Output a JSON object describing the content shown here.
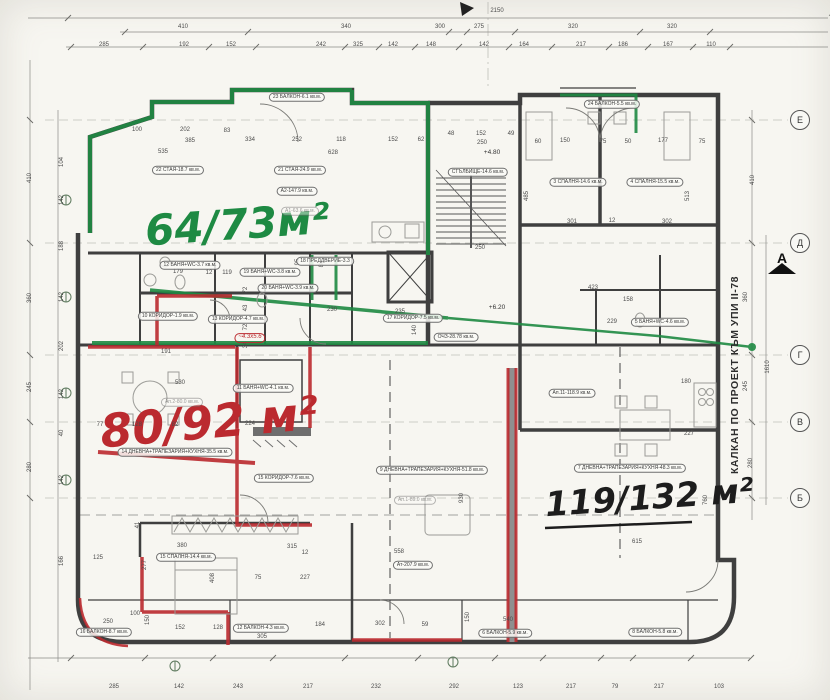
{
  "annotations": {
    "green": {
      "text": "64/73м²",
      "color": "#1e8a43"
    },
    "red": {
      "text": "80/92 м²",
      "color": "#bb2a2f"
    },
    "black": {
      "text": "119/132 м²",
      "color": "#1d1d1d"
    }
  },
  "side_note": {
    "text": "КАЛКАН ПО ПРОЕКТ КЪМ УПИ II-78"
  },
  "section_marker": {
    "label": "А"
  },
  "axis_markers": [
    {
      "label": "Е",
      "x": 800,
      "y": 120
    },
    {
      "label": "Д",
      "x": 800,
      "y": 243
    },
    {
      "label": "Г",
      "x": 800,
      "y": 355
    },
    {
      "label": "В",
      "x": 800,
      "y": 422
    },
    {
      "label": "Б",
      "x": 800,
      "y": 498
    }
  ],
  "room_labels": [
    {
      "t": "22 СТАЯ-18.7 кв.м.",
      "x": 178,
      "y": 170,
      "s": "o"
    },
    {
      "t": "21 СТАЯ-24.9 кв.м.",
      "x": 300,
      "y": 170,
      "s": "o"
    },
    {
      "t": "А2-147.9 кв.м.",
      "x": 297,
      "y": 191,
      "s": "o"
    },
    {
      "t": "А1-63.6 кв.м.",
      "x": 300,
      "y": 211,
      "s": "f"
    },
    {
      "t": "23 БАЛКОН-6.1 кв.м.",
      "x": 297,
      "y": 97,
      "s": "o"
    },
    {
      "t": "24 БАЛКОН-5.5 кв.м.",
      "x": 612,
      "y": 104,
      "s": "o"
    },
    {
      "t": "3 СПАЛНЯ-14.6 кв.м.",
      "x": 578,
      "y": 182,
      "s": "o"
    },
    {
      "t": "4 СПАЛНЯ-15.5 кв.м.",
      "x": 655,
      "y": 182,
      "s": "o"
    },
    {
      "t": "СТЪЛБИЩЕ-14.6 кв.м.",
      "x": 478,
      "y": 172,
      "s": "o"
    },
    {
      "t": "+4.80",
      "x": 492,
      "y": 153,
      "s": "p"
    },
    {
      "t": "+6.20",
      "x": 497,
      "y": 308,
      "s": "p"
    },
    {
      "t": "17 КОРИДОР-7.5 кв.м.",
      "x": 413,
      "y": 318,
      "s": "o"
    },
    {
      "t": "ОЧЗ-28.78 кв.м.",
      "x": 456,
      "y": 337,
      "s": "o"
    },
    {
      "t": "18 ПРЕДДВЕРИЕ-3.3",
      "x": 325,
      "y": 261,
      "s": "o"
    },
    {
      "t": "19 БАНЯ+WC-3.8 кв.м.",
      "x": 270,
      "y": 272,
      "s": "o"
    },
    {
      "t": "12 БАНЯ+WC-3.7 кв.м.",
      "x": 190,
      "y": 265,
      "s": "o"
    },
    {
      "t": "20 БАНЯ+WC-3.9 кв.м.",
      "x": 288,
      "y": 288,
      "s": "o"
    },
    {
      "t": "10 КОРИДОР-1.9 кв.м.",
      "x": 168,
      "y": 316,
      "s": "o"
    },
    {
      "t": "13 КОРИДОР-4.7 кв.м.",
      "x": 238,
      "y": 319,
      "s": "o"
    },
    {
      "t": "~4.3х5.6",
      "x": 250,
      "y": 338,
      "s": "hr"
    },
    {
      "t": "Ап.2-80.0 кв.м.",
      "x": 182,
      "y": 402,
      "s": "f"
    },
    {
      "t": "14 ДНЕВНА+ТРАПЕЗАРИЯ+КУХНЯ-35.5 кв.м.",
      "x": 175,
      "y": 452,
      "s": "o"
    },
    {
      "t": "11 БАНЯ+WC-4.1 кв.м.",
      "x": 263,
      "y": 388,
      "s": "o"
    },
    {
      "t": "15 КОРИДОР-7.6 кв.м.",
      "x": 284,
      "y": 478,
      "s": "o"
    },
    {
      "t": "15 СПАЛНЯ-14.4 кв.м.",
      "x": 186,
      "y": 557,
      "s": "o"
    },
    {
      "t": "16 БАЛКОН-8.7 кв.м.",
      "x": 104,
      "y": 632,
      "s": "o"
    },
    {
      "t": "12 БАЛКОН-4.3 кв.м.",
      "x": 261,
      "y": 628,
      "s": "o"
    },
    {
      "t": "6 БАЛКОН-5.9 кв.м.",
      "x": 505,
      "y": 633,
      "s": "o"
    },
    {
      "t": "8 БАЛКОН-5.8 кв.м.",
      "x": 655,
      "y": 632,
      "s": "o"
    },
    {
      "t": "9 ДНЕВНА+ТРАПЕЗАРИЯ+КУХНЯ-51.8 кв.м.",
      "x": 432,
      "y": 470,
      "s": "o"
    },
    {
      "t": "Ап.1-89.0 кв.м.",
      "x": 415,
      "y": 500,
      "s": "f"
    },
    {
      "t": "Ат-207.9 кв.м.",
      "x": 413,
      "y": 565,
      "s": "o"
    },
    {
      "t": "Ап.11-118.9 кв.м.",
      "x": 572,
      "y": 393,
      "s": "o"
    },
    {
      "t": "7 ДНЕВНА+ТРАПЕЗАРИЯ+КУХНЯ-48.3 кв.м.",
      "x": 630,
      "y": 468,
      "s": "o"
    },
    {
      "t": "5 БАНЯ+WC-4.6 кв.м.",
      "x": 660,
      "y": 322,
      "s": "o"
    }
  ],
  "dim_labels": [
    {
      "t": "2150",
      "x": 497,
      "y": 11
    },
    {
      "t": "410",
      "x": 183,
      "y": 27
    },
    {
      "t": "340",
      "x": 346,
      "y": 27
    },
    {
      "t": "300",
      "x": 440,
      "y": 27
    },
    {
      "t": "275",
      "x": 479,
      "y": 27
    },
    {
      "t": "320",
      "x": 573,
      "y": 27
    },
    {
      "t": "320",
      "x": 672,
      "y": 27
    },
    {
      "t": "285",
      "x": 104,
      "y": 45
    },
    {
      "t": "192",
      "x": 184,
      "y": 45
    },
    {
      "t": "152",
      "x": 231,
      "y": 45
    },
    {
      "t": "242",
      "x": 321,
      "y": 45
    },
    {
      "t": "325",
      "x": 358,
      "y": 45
    },
    {
      "t": "142",
      "x": 393,
      "y": 45
    },
    {
      "t": "148",
      "x": 431,
      "y": 45
    },
    {
      "t": "142",
      "x": 484,
      "y": 45
    },
    {
      "t": "164",
      "x": 524,
      "y": 45
    },
    {
      "t": "217",
      "x": 581,
      "y": 45
    },
    {
      "t": "186",
      "x": 623,
      "y": 45
    },
    {
      "t": "167",
      "x": 668,
      "y": 45
    },
    {
      "t": "110",
      "x": 711,
      "y": 45
    },
    {
      "t": "285",
      "x": 114,
      "y": 687
    },
    {
      "t": "142",
      "x": 179,
      "y": 687
    },
    {
      "t": "243",
      "x": 238,
      "y": 687
    },
    {
      "t": "217",
      "x": 308,
      "y": 687
    },
    {
      "t": "232",
      "x": 376,
      "y": 687
    },
    {
      "t": "292",
      "x": 454,
      "y": 687
    },
    {
      "t": "123",
      "x": 518,
      "y": 687
    },
    {
      "t": "217",
      "x": 571,
      "y": 687
    },
    {
      "t": "79",
      "x": 615,
      "y": 687
    },
    {
      "t": "217",
      "x": 659,
      "y": 687
    },
    {
      "t": "103",
      "x": 719,
      "y": 687
    },
    {
      "t": "410",
      "x": 30,
      "y": 178,
      "r": -90
    },
    {
      "t": "360",
      "x": 30,
      "y": 298,
      "r": -90
    },
    {
      "t": "245",
      "x": 30,
      "y": 387,
      "r": -90
    },
    {
      "t": "280",
      "x": 30,
      "y": 467,
      "r": -90
    },
    {
      "t": "104",
      "x": 62,
      "y": 162,
      "r": -90
    },
    {
      "t": "142",
      "x": 62,
      "y": 200,
      "r": -90
    },
    {
      "t": "188",
      "x": 62,
      "y": 246,
      "r": -90
    },
    {
      "t": "142",
      "x": 62,
      "y": 297,
      "r": -90
    },
    {
      "t": "202",
      "x": 62,
      "y": 346,
      "r": -90
    },
    {
      "t": "142",
      "x": 62,
      "y": 394,
      "r": -90
    },
    {
      "t": "40",
      "x": 62,
      "y": 433,
      "r": -90
    },
    {
      "t": "142",
      "x": 62,
      "y": 480,
      "r": -90
    },
    {
      "t": "166",
      "x": 62,
      "y": 561,
      "r": -90
    },
    {
      "t": "410",
      "x": 753,
      "y": 180,
      "r": -90
    },
    {
      "t": "360",
      "x": 746,
      "y": 297,
      "r": -90
    },
    {
      "t": "1610",
      "x": 768,
      "y": 367,
      "r": -90
    },
    {
      "t": "245",
      "x": 746,
      "y": 386,
      "r": -90
    },
    {
      "t": "280",
      "x": 751,
      "y": 463,
      "r": -90
    },
    {
      "t": "760",
      "x": 706,
      "y": 500,
      "r": -90
    },
    {
      "t": "180",
      "x": 686,
      "y": 382
    },
    {
      "t": "615",
      "x": 637,
      "y": 542
    },
    {
      "t": "100",
      "x": 137,
      "y": 130
    },
    {
      "t": "202",
      "x": 185,
      "y": 130
    },
    {
      "t": "83",
      "x": 227,
      "y": 131
    },
    {
      "t": "385",
      "x": 190,
      "y": 141
    },
    {
      "t": "535",
      "x": 163,
      "y": 152
    },
    {
      "t": "334",
      "x": 250,
      "y": 140
    },
    {
      "t": "252",
      "x": 297,
      "y": 140
    },
    {
      "t": "118",
      "x": 341,
      "y": 140
    },
    {
      "t": "152",
      "x": 393,
      "y": 140
    },
    {
      "t": "62",
      "x": 421,
      "y": 140
    },
    {
      "t": "628",
      "x": 333,
      "y": 153
    },
    {
      "t": "48",
      "x": 451,
      "y": 134
    },
    {
      "t": "152",
      "x": 481,
      "y": 134
    },
    {
      "t": "49",
      "x": 511,
      "y": 134
    },
    {
      "t": "250",
      "x": 482,
      "y": 143
    },
    {
      "t": "250",
      "x": 480,
      "y": 248
    },
    {
      "t": "60",
      "x": 538,
      "y": 142
    },
    {
      "t": "150",
      "x": 565,
      "y": 141
    },
    {
      "t": "75",
      "x": 603,
      "y": 142
    },
    {
      "t": "50",
      "x": 628,
      "y": 142
    },
    {
      "t": "177",
      "x": 663,
      "y": 141
    },
    {
      "t": "75",
      "x": 702,
      "y": 142
    },
    {
      "t": "301",
      "x": 572,
      "y": 222
    },
    {
      "t": "12",
      "x": 612,
      "y": 221
    },
    {
      "t": "302",
      "x": 667,
      "y": 222
    },
    {
      "t": "513",
      "x": 688,
      "y": 196,
      "r": -90
    },
    {
      "t": "485",
      "x": 527,
      "y": 196,
      "r": -90
    },
    {
      "t": "230",
      "x": 332,
      "y": 310
    },
    {
      "t": "235",
      "x": 400,
      "y": 312
    },
    {
      "t": "140",
      "x": 415,
      "y": 330,
      "r": -90
    },
    {
      "t": "423",
      "x": 593,
      "y": 288
    },
    {
      "t": "158",
      "x": 628,
      "y": 300
    },
    {
      "t": "229",
      "x": 612,
      "y": 322
    },
    {
      "t": "179",
      "x": 178,
      "y": 272
    },
    {
      "t": "12",
      "x": 209,
      "y": 273
    },
    {
      "t": "119",
      "x": 227,
      "y": 273
    },
    {
      "t": "95",
      "x": 298,
      "y": 262,
      "r": -90
    },
    {
      "t": "80",
      "x": 322,
      "y": 264,
      "r": -90
    },
    {
      "t": "72",
      "x": 246,
      "y": 290,
      "r": -90
    },
    {
      "t": "43",
      "x": 246,
      "y": 308,
      "r": -90
    },
    {
      "t": "72",
      "x": 246,
      "y": 327,
      "r": -90
    },
    {
      "t": "34",
      "x": 246,
      "y": 345,
      "r": -90
    },
    {
      "t": "191",
      "x": 166,
      "y": 352
    },
    {
      "t": "530",
      "x": 180,
      "y": 383
    },
    {
      "t": "77",
      "x": 100,
      "y": 425
    },
    {
      "t": "128",
      "x": 137,
      "y": 425
    },
    {
      "t": "82",
      "x": 175,
      "y": 425
    },
    {
      "t": "224",
      "x": 250,
      "y": 424
    },
    {
      "t": "380",
      "x": 182,
      "y": 546
    },
    {
      "t": "125",
      "x": 98,
      "y": 558
    },
    {
      "t": "408",
      "x": 213,
      "y": 578,
      "r": -90
    },
    {
      "t": "100",
      "x": 135,
      "y": 614
    },
    {
      "t": "250",
      "x": 108,
      "y": 622
    },
    {
      "t": "152",
      "x": 180,
      "y": 628
    },
    {
      "t": "128",
      "x": 218,
      "y": 628
    },
    {
      "t": "305",
      "x": 262,
      "y": 637
    },
    {
      "t": "150",
      "x": 148,
      "y": 620,
      "r": -90
    },
    {
      "t": "277",
      "x": 145,
      "y": 565,
      "r": -90
    },
    {
      "t": "41",
      "x": 138,
      "y": 525,
      "r": -90
    },
    {
      "t": "558",
      "x": 399,
      "y": 552
    },
    {
      "t": "930",
      "x": 462,
      "y": 498,
      "r": -90
    },
    {
      "t": "12",
      "x": 305,
      "y": 553
    },
    {
      "t": "184",
      "x": 320,
      "y": 625
    },
    {
      "t": "302",
      "x": 380,
      "y": 624
    },
    {
      "t": "59",
      "x": 425,
      "y": 625
    },
    {
      "t": "150",
      "x": 468,
      "y": 617,
      "r": -90
    },
    {
      "t": "540",
      "x": 508,
      "y": 620
    },
    {
      "t": "315",
      "x": 292,
      "y": 547
    },
    {
      "t": "75",
      "x": 258,
      "y": 578
    },
    {
      "t": "227",
      "x": 305,
      "y": 578
    },
    {
      "t": "227",
      "x": 689,
      "y": 434
    }
  ]
}
